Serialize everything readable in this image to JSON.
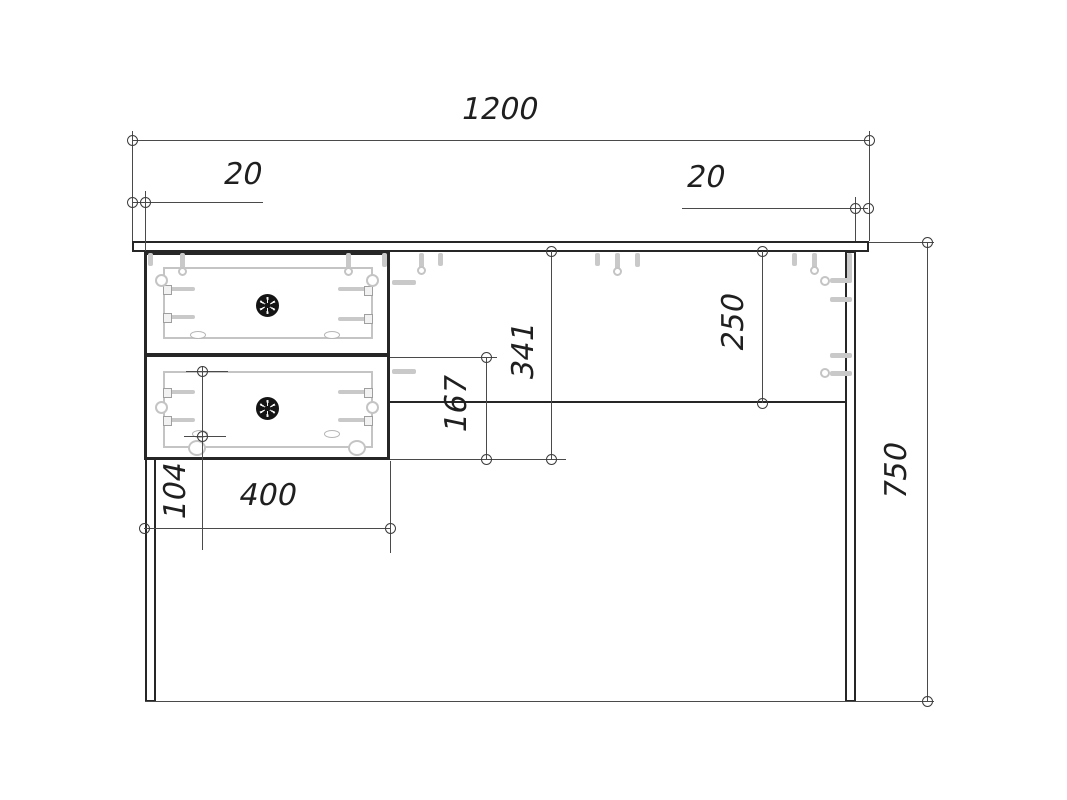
{
  "drawing": {
    "dims": {
      "overall_width": "1200",
      "left_overhang": "20",
      "right_overhang": "20",
      "overall_height": "750",
      "drawer_stack_height": "341",
      "lower_drawer_height": "167",
      "back_apron_height": "250",
      "drawer_front_width": "400",
      "slide_offset": "104"
    },
    "colors": {
      "outline": "#262626",
      "dimension_line": "#4a4a4a",
      "hardware": "#c9c9c9",
      "knob": "#141414",
      "background": "#ffffff"
    },
    "icons": {
      "knob": "drawer-knob-icon",
      "dowel": "dowel-icon",
      "cam_fitting": "cam-fitting-icon"
    }
  }
}
